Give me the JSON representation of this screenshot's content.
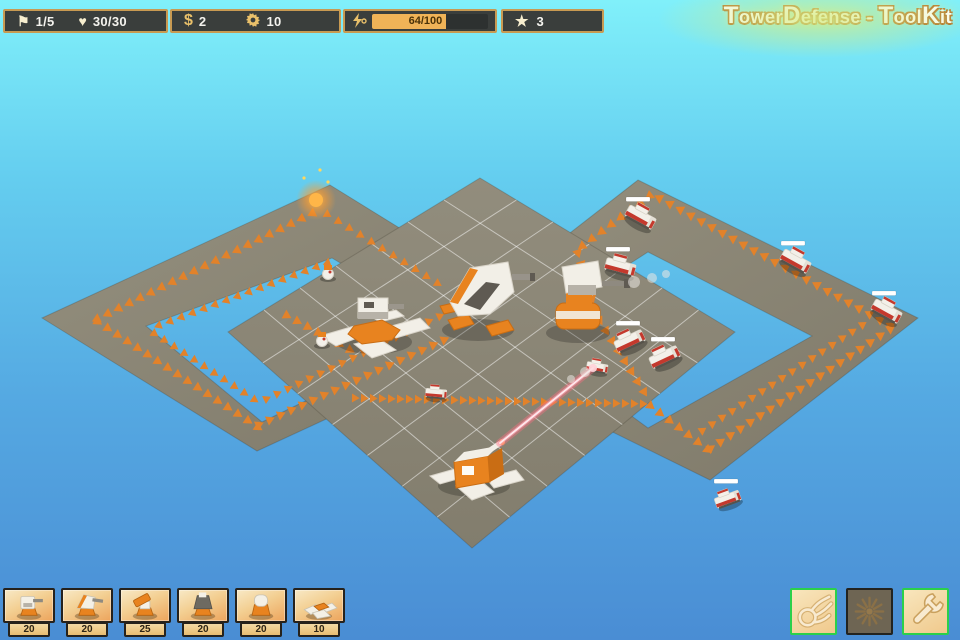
{
  "hud": {
    "wave": {
      "glyph": "⚑",
      "value": "1/5"
    },
    "lives": {
      "glyph": "♥",
      "value": "30/30"
    },
    "money": {
      "glyph": "$",
      "value": "2"
    },
    "parts": {
      "value": "10"
    },
    "energy": {
      "value": "64/100",
      "percent": 64
    },
    "stars": {
      "glyph": "★",
      "value": "3"
    }
  },
  "logo": {
    "title": "TowerDefense - ToolKit"
  },
  "build_menu": {
    "items": [
      {
        "name": "tower-gun",
        "cost": "20"
      },
      {
        "name": "tower-cannon",
        "cost": "20"
      },
      {
        "name": "tower-rocket",
        "cost": "25"
      },
      {
        "name": "tower-tesla",
        "cost": "20"
      },
      {
        "name": "tower-dome",
        "cost": "20"
      },
      {
        "name": "tower-mine",
        "cost": "10"
      }
    ]
  },
  "action_menu": {
    "items": [
      {
        "name": "fireball-button",
        "icon": "fireball-icon",
        "enabled": true
      },
      {
        "name": "airstrike-button",
        "icon": "burst-icon",
        "enabled": false
      },
      {
        "name": "settings-button",
        "icon": "wrench-icon",
        "enabled": true
      }
    ]
  },
  "colors": {
    "accent_orange": "#e8831f",
    "hud_border": "#c89a52",
    "hud_bg": "#3a3e3c",
    "energy_fill": "#f0b357",
    "button_green": "#2bd04b",
    "sky_top": "#80f0fa",
    "sky_bottom": "#4a8dd4"
  },
  "scene": {
    "road_color_light": "#95907f",
    "road_color_dark": "#7e7969",
    "platform_top": "#928d7d",
    "platform_bottom": "#827d6d",
    "grid_color": "rgba(255,255,255,0.5)",
    "chevron_color": "#e2822a",
    "left_loop": {
      "outer": [
        [
          330,
          185
        ],
        [
          545,
          318
        ],
        [
          257,
          451
        ],
        [
          42,
          318
        ]
      ],
      "inner": [
        [
          332,
          258
        ],
        [
          452,
          330
        ],
        [
          262,
          422
        ],
        [
          146,
          326
        ]
      ]
    },
    "right_loop": {
      "outer": [
        [
          638,
          180
        ],
        [
          918,
          318
        ],
        [
          710,
          480
        ],
        [
          430,
          342
        ]
      ],
      "inner": [
        [
          648,
          252
        ],
        [
          812,
          336
        ],
        [
          648,
          428
        ],
        [
          520,
          334
        ]
      ]
    },
    "platform": [
      [
        480,
        178
      ],
      [
        735,
        332
      ],
      [
        472,
        548
      ],
      [
        228,
        332
      ]
    ],
    "grid_divisions": 7,
    "spawn": {
      "x": 316,
      "y": 200
    },
    "trails": [
      {
        "pts": [
          [
            315,
            212
          ],
          [
            95,
            320
          ]
        ],
        "sp": 12,
        "sz": 5
      },
      {
        "pts": [
          [
            330,
            262
          ],
          [
            152,
            328
          ]
        ],
        "sp": 12,
        "sz": 4.5
      },
      {
        "pts": [
          [
            95,
            320
          ],
          [
            256,
            426
          ]
        ],
        "sp": 12,
        "sz": 5
      },
      {
        "pts": [
          [
            152,
            332
          ],
          [
            258,
            402
          ]
        ],
        "sp": 12,
        "sz": 4.5
      },
      {
        "pts": [
          [
            256,
            426
          ],
          [
            448,
            338
          ]
        ],
        "sp": 12,
        "sz": 5
      },
      {
        "pts": [
          [
            264,
            400
          ],
          [
            440,
            316
          ]
        ],
        "sp": 12,
        "sz": 4.5
      },
      {
        "pts": [
          [
            325,
            213
          ],
          [
            445,
            288
          ]
        ],
        "sp": 13,
        "sz": 4.5
      },
      {
        "pts": [
          [
            284,
            314
          ],
          [
            350,
            350
          ]
        ],
        "sp": 12,
        "sz": 5
      },
      {
        "pts": [
          [
            352,
            398
          ],
          [
            648,
            404
          ]
        ],
        "sp": 9,
        "sz": 4.5
      },
      {
        "pts": [
          [
            648,
            404
          ],
          [
            708,
            450
          ],
          [
            893,
            327
          ]
        ],
        "sp": 12,
        "sz": 5
      },
      {
        "pts": [
          [
            700,
            432
          ],
          [
            862,
            325
          ]
        ],
        "sp": 12,
        "sz": 4.5
      },
      {
        "pts": [
          [
            893,
            327
          ],
          [
            652,
            194
          ]
        ],
        "sp": 12,
        "sz": 5
      },
      {
        "pts": [
          [
            652,
            194
          ],
          [
            577,
            250
          ],
          [
            598,
            318
          ],
          [
            648,
            398
          ]
        ],
        "sp": 12,
        "sz": 5
      }
    ],
    "towers": [
      {
        "type": "flak",
        "x": 374,
        "y": 332
      },
      {
        "type": "cannon",
        "x": 478,
        "y": 310
      },
      {
        "type": "gunner",
        "x": 578,
        "y": 315
      },
      {
        "type": "laser",
        "x": 474,
        "y": 470
      }
    ],
    "enemies": [
      {
        "type": "car",
        "x": 640,
        "y": 218,
        "a": 29,
        "s": 1,
        "hb": true
      },
      {
        "type": "car",
        "x": 795,
        "y": 262,
        "a": 29,
        "s": 1,
        "hb": true
      },
      {
        "type": "car",
        "x": 886,
        "y": 312,
        "a": 29,
        "s": 1,
        "hb": true
      },
      {
        "type": "car",
        "x": 620,
        "y": 268,
        "a": 15,
        "s": 1,
        "hb": true
      },
      {
        "type": "car",
        "x": 630,
        "y": 342,
        "a": -25,
        "s": 1,
        "hb": true
      },
      {
        "type": "car",
        "x": 665,
        "y": 358,
        "a": -25,
        "s": 1,
        "hb": true
      },
      {
        "type": "car",
        "x": 597,
        "y": 368,
        "a": 10,
        "s": 0.7,
        "hb": false
      },
      {
        "type": "car",
        "x": 728,
        "y": 500,
        "a": -20,
        "s": 0.85,
        "hb": true
      },
      {
        "type": "car",
        "x": 436,
        "y": 394,
        "a": 5,
        "s": 0.7,
        "hb": false
      },
      {
        "type": "crawler",
        "x": 328,
        "y": 274,
        "a": 0,
        "s": 1,
        "hb": false
      },
      {
        "type": "crawler",
        "x": 322,
        "y": 341,
        "a": 0,
        "s": 1,
        "hb": false
      }
    ],
    "laser": {
      "x1": 500,
      "y1": 443,
      "x2": 593,
      "y2": 368
    },
    "smoke": [
      [
        634,
        282,
        6
      ],
      [
        652,
        278,
        5
      ],
      [
        666,
        274,
        4
      ],
      [
        585,
        372,
        5
      ],
      [
        571,
        379,
        4
      ]
    ]
  }
}
